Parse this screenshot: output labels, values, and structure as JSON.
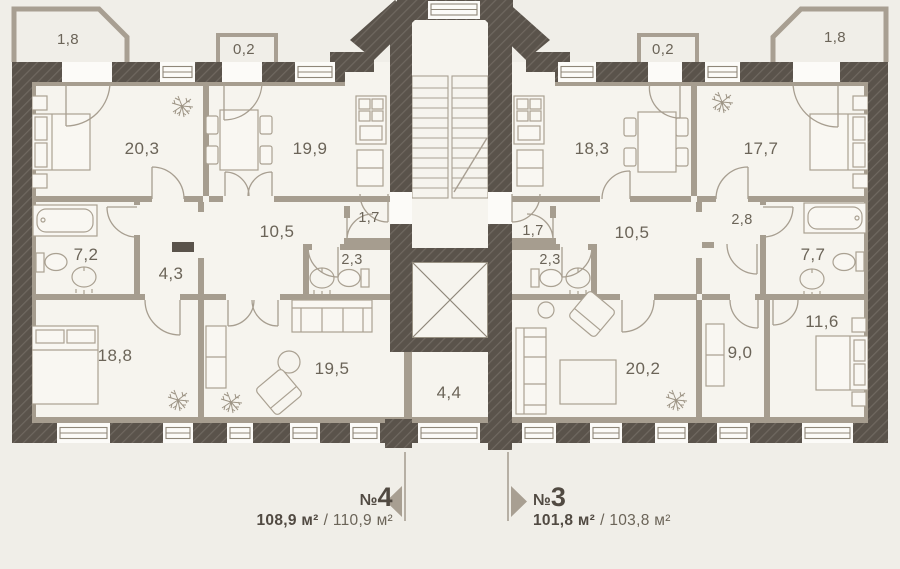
{
  "floor_plan": {
    "common": {
      "vestibule_area": "4,4"
    },
    "apartment_4": {
      "prefix": "№",
      "number": "4",
      "area_primary": "108,9 м²",
      "area_secondary": "/ 110,9 м²",
      "rooms": {
        "bedroom_top": "20,3",
        "kitchen": "19,9",
        "corridor": "10,5",
        "closet": "1,7",
        "wc": "2,3",
        "bathroom": "7,2",
        "hall": "4,3",
        "bedroom_bottom": "18,8",
        "living": "19,5",
        "balcony": "1,8",
        "balcony_small": "0,2"
      }
    },
    "apartment_3": {
      "prefix": "№",
      "number": "3",
      "area_primary": "101,8 м²",
      "area_secondary": "/ 103,8 м²",
      "rooms": {
        "kitchen": "18,3",
        "bedroom_top": "17,7",
        "corridor": "10,5",
        "closet": "1,7",
        "wc": "2,3",
        "hall": "2,8",
        "bathroom": "7,7",
        "bedroom_bottom": "11,6",
        "cabinet": "9,0",
        "living": "20,2",
        "balcony": "1,8",
        "balcony_small": "0,2"
      }
    }
  }
}
